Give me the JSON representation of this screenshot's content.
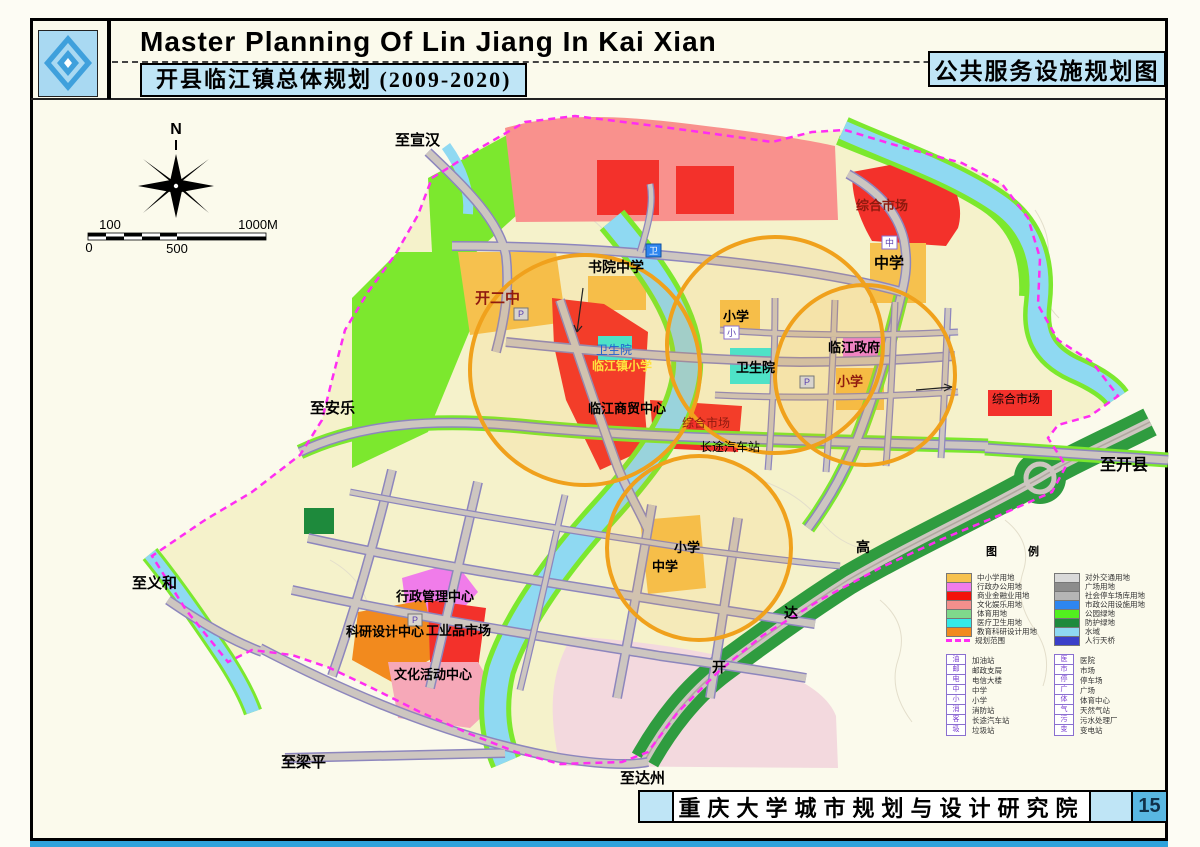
{
  "header": {
    "title_en": "Master Planning Of Lin Jiang In Kai Xian",
    "title_cn": "开县临江镇总体规划 (2009-2020)",
    "map_name": "公共服务设施规划图"
  },
  "compass": {
    "north": "N"
  },
  "scale": {
    "top_left": "100",
    "top_right": "1000M",
    "bottom_left": "0",
    "bottom_mid": "500"
  },
  "footer": {
    "institute": "重庆大学城市规划与设计研究院",
    "page": "15"
  },
  "legend": {
    "title": "图 例",
    "zones_left": [
      {
        "color": "#F6C14E",
        "label": "中小学用地"
      },
      {
        "color": "#F07CEA",
        "label": "行政办公用地"
      },
      {
        "color": "#F3120B",
        "label": "商业金融业用地"
      },
      {
        "color": "#F48F8C",
        "label": "文化娱乐用地"
      },
      {
        "color": "#7FD98B",
        "label": "体育用地"
      },
      {
        "color": "#35E9E9",
        "label": "医疗卫生用地"
      },
      {
        "color": "#F28A1E",
        "label": "教育科研设计用地"
      },
      {
        "color": "#FF2DF2",
        "label": "规划范围"
      }
    ],
    "zones_right": [
      {
        "color": "#D9D9D9",
        "label": "对外交通用地"
      },
      {
        "color": "#8C8C8C",
        "label": "广场用地"
      },
      {
        "color": "#B5B5B5",
        "label": "社会停车场库用地"
      },
      {
        "color": "#2E86F0",
        "label": "市政公用设施用地"
      },
      {
        "color": "#52F01F",
        "label": "公园绿地"
      },
      {
        "color": "#1E8A3C",
        "label": "防护绿地"
      },
      {
        "color": "#8FD9F2",
        "label": "水域"
      },
      {
        "color": "#3A3FC9",
        "label": "人行天桥"
      }
    ],
    "symbols_left": [
      {
        "glyph": "油",
        "label": "加油站"
      },
      {
        "glyph": "邮",
        "label": "邮政支局"
      },
      {
        "glyph": "电",
        "label": "电信大楼"
      },
      {
        "glyph": "中",
        "label": "中学"
      },
      {
        "glyph": "小",
        "label": "小学"
      },
      {
        "glyph": "消",
        "label": "消防站"
      },
      {
        "glyph": "客",
        "label": "长途汽车站"
      },
      {
        "glyph": "圾",
        "label": "垃圾站"
      }
    ],
    "symbols_right": [
      {
        "glyph": "医",
        "label": "医院"
      },
      {
        "glyph": "市",
        "label": "市场"
      },
      {
        "glyph": "停",
        "label": "停车场"
      },
      {
        "glyph": "广",
        "label": "广场"
      },
      {
        "glyph": "体",
        "label": "体育中心"
      },
      {
        "glyph": "气",
        "label": "天然气站"
      },
      {
        "glyph": "污",
        "label": "污水处理厂"
      },
      {
        "glyph": "变",
        "label": "变电站"
      }
    ]
  },
  "map": {
    "labels": [
      "至宣汉",
      "至安乐",
      "至义和",
      "至梁平",
      "至达州",
      "至开县",
      "开二中",
      "书院中学",
      "综合市场",
      "中学",
      "小学",
      "卫生院",
      "卫生院",
      "临江镇小学",
      "临江商贸中心",
      "综合市场",
      "长途汽车站",
      "临江政府",
      "小学",
      "综合市场",
      "行政管理中心",
      "科研设计中心",
      "工业品市场",
      "文化活动中心",
      "小学",
      "中学",
      "高",
      "达",
      "开"
    ],
    "markers": [
      "卫",
      "中",
      "小",
      "P",
      "P",
      "P"
    ]
  },
  "colors": {
    "land": "#F5F2CB",
    "water": "#8FD9F2",
    "wedge": "#3F86C9",
    "park": "#7CE82E",
    "hwgreen": "#2F9C3F",
    "salmon": "#F9918D",
    "red": "#F3312B",
    "school": "#F6C14E",
    "eduor": "#F28A1E",
    "magadmin": "#F07CEA",
    "cyanmed": "#3BE9DB",
    "pinkcult": "#F6A8B8",
    "palepink": "#F3D9DE",
    "road": "#CDC6C0",
    "roadedge": "#8D86BD",
    "circleor": "#F0A11C",
    "boundary": "#FF2DF2",
    "lblue": "#BFE5F6",
    "pnumbg": "#59B7E2",
    "dgreen": "#1E8A3C",
    "bstrip": "#2FA3DC",
    "labdarkred": "#8F1A0F",
    "labyellow": "#FFE23D",
    "labblue": "#1F5FD0"
  }
}
